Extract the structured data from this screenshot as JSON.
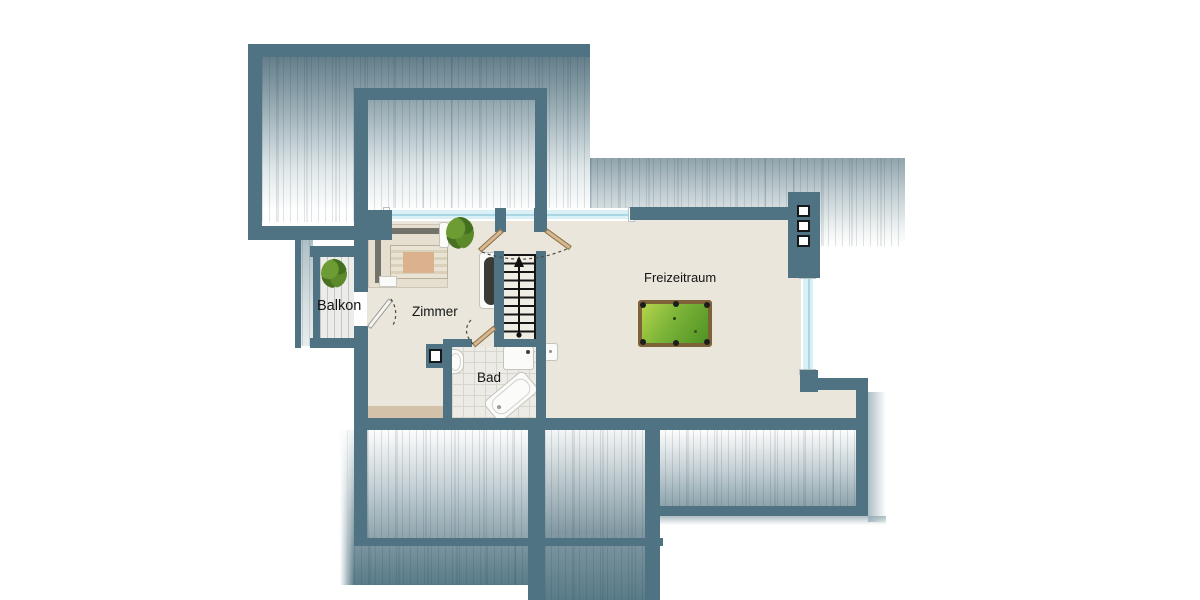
{
  "plan": {
    "type": "floorplan",
    "floor_label": "",
    "rooms": [
      {
        "key": "balkon",
        "label": "Balkon"
      },
      {
        "key": "zimmer",
        "label": "Zimmer"
      },
      {
        "key": "bad",
        "label": "Bad"
      },
      {
        "key": "freizeitraum",
        "label": "Freizeitraum"
      }
    ],
    "furniture": [
      "bed",
      "nightstand",
      "sideboard",
      "staircase",
      "stairs-up-arrow",
      "double-door",
      "balcony-door",
      "bath-door",
      "bathtub",
      "shower-tray",
      "washbasin-bad",
      "washbasin-freizeitraum",
      "pool-table",
      "plant-zimmer",
      "plant-balkon",
      "chimney",
      "ventilation-shaft"
    ],
    "colors": {
      "wall": "#4f7383",
      "roof_dark": "#56727f",
      "roof_light": "#ffffff",
      "floor": "#eae6db",
      "window_glass": "#d9f0f6",
      "bath_tile": "#edebe5",
      "deck": "#ececea",
      "door_leaf": "#d7b893",
      "pool_felt_light": "#b6d44d",
      "pool_felt_dark": "#4f9224",
      "pool_frame": "#7c6236",
      "accent_plant": "#5a8a2a"
    }
  }
}
